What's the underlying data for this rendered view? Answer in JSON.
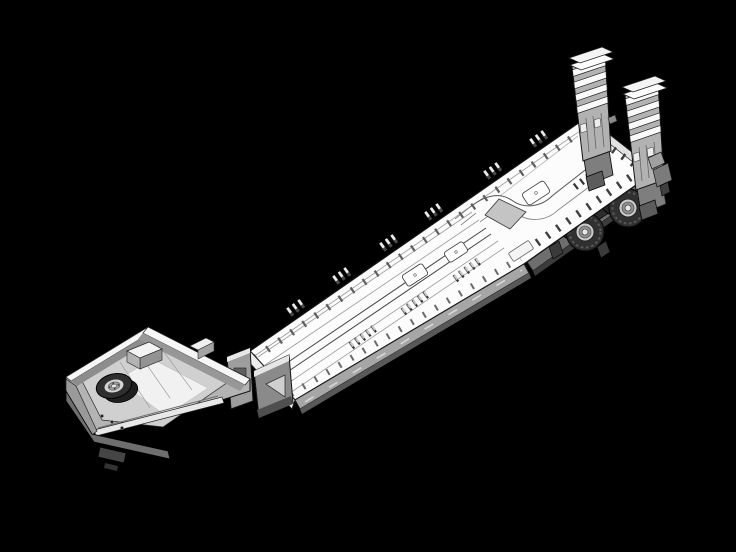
{
  "meta": {
    "description": "Monochrome isometric CAD rendering of a detachable-gooseneck lowboy trailer shown in three-quarter view on a solid black background: open gooseneck tray with spare wheel and toolbox at the lower left, support pedestal, long lowered plank deck with tie-down clusters, fold-flat outriggers and access hatches, raised rear deck over tandem dual-tire axles, and two upright flip-over loading ramps at the upper right."
  },
  "canvas": {
    "width": 736,
    "height": 552,
    "background_color": "#000000"
  },
  "palette": {
    "background": "#000000",
    "outline": "#141414",
    "deck_top": "#fcfcfc",
    "edge_face": "#e2e2e2",
    "light_face": "#d0d0d0",
    "mid_face": "#a6a6a6",
    "dark_face": "#6e6e6e",
    "darker_face": "#454545",
    "ramp_face": "#b2b2b2",
    "slat_white": "#fafafa",
    "tire": "#303030",
    "rim": "#c9c9c9",
    "hub": "#e8e8e8"
  },
  "parts": [
    "gooseneck-tray",
    "spare-tire",
    "toolbox",
    "front-bumper",
    "kingpin-plate",
    "gooseneck-riser",
    "support-pedestal",
    "main-deck",
    "deck-planks",
    "tie-down-clusters",
    "fold-out-outriggers",
    "deck-hatches",
    "side-skirt",
    "transition-ramp",
    "rear-deck",
    "wheel-hump-contours",
    "rear-frame",
    "axle-group",
    "wheel-assembly-front",
    "wheel-assembly-rear",
    "loading-ramp-left",
    "loading-ramp-right",
    "rear-corner-hardware"
  ]
}
